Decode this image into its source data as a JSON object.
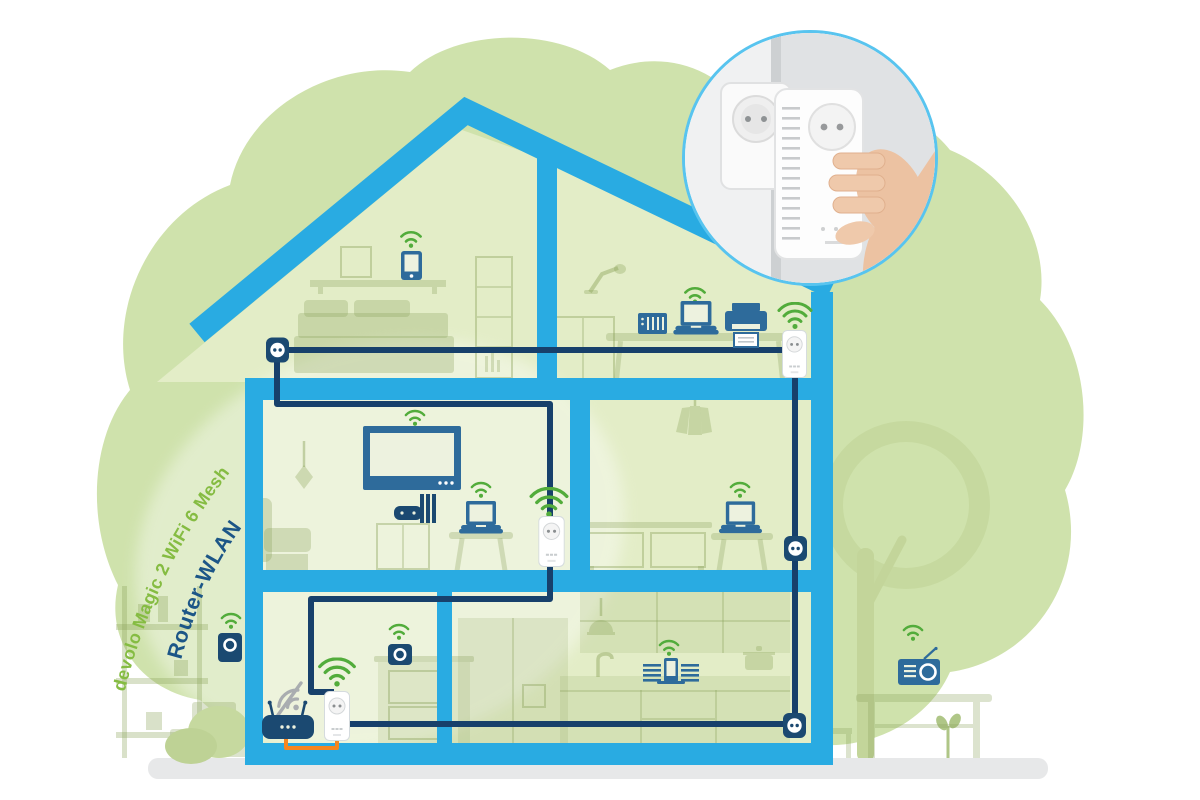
{
  "labels": {
    "product_mesh": "devolo Magic 2 WiFi 6 Mesh",
    "router_wlan": "Router-WLAN"
  },
  "palette": {
    "house_blue": "#29ABE2",
    "cable_navy": "#17406B",
    "device_blue": "#2E6B9B",
    "device_navy": "#1B4971",
    "wifi_green": "#52AC3B",
    "label_green": "#85BC42",
    "label_navy": "#1C5687",
    "cloud_green": "#CFE2AC",
    "room_green": "#E3EDC7",
    "lan_cable_orange": "#F6861F",
    "ground_gray": "#E7E8E9",
    "inset_ring_blue": "#58C4EF",
    "wifi_off_gray": "#A9ADB0"
  },
  "icon_inventory": [
    "wifi-icon",
    "wifi-large-icon",
    "wifi-off-icon",
    "powerline-adapter",
    "power-socket",
    "router",
    "laptop",
    "tablet",
    "tv",
    "printer",
    "nas-server",
    "game-console",
    "speaker",
    "smartphone-dock",
    "radio",
    "hand-plugging-adapter"
  ]
}
